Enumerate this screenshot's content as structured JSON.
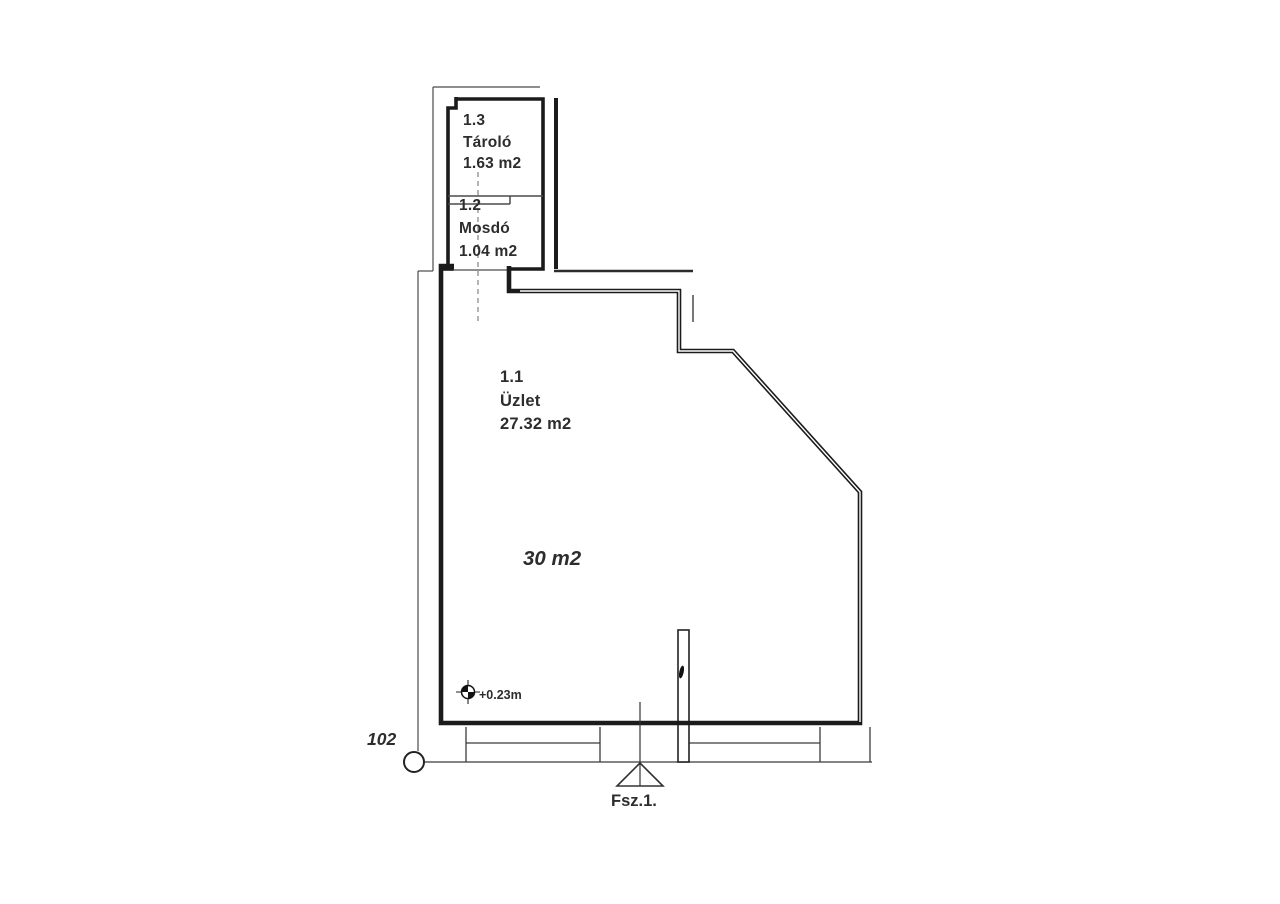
{
  "page": {
    "background": "#ffffff",
    "wall_color": "#1b1b1b",
    "thin_line_color": "#4a4a4a",
    "text_color": "#2d2d2d"
  },
  "floorplan": {
    "rooms": [
      {
        "number": "1.3",
        "name": "Tároló",
        "area": "1.63 m2"
      },
      {
        "number": "1.2",
        "name": "Mosdó",
        "area": "1.04 m2"
      },
      {
        "number": "1.1",
        "name": "Üzlet",
        "area": "27.32 m2"
      }
    ],
    "annotations": {
      "total_area": "30 m2",
      "floor_level": "+0.23m",
      "node_number": "102",
      "section_label": "Fsz.1."
    }
  }
}
